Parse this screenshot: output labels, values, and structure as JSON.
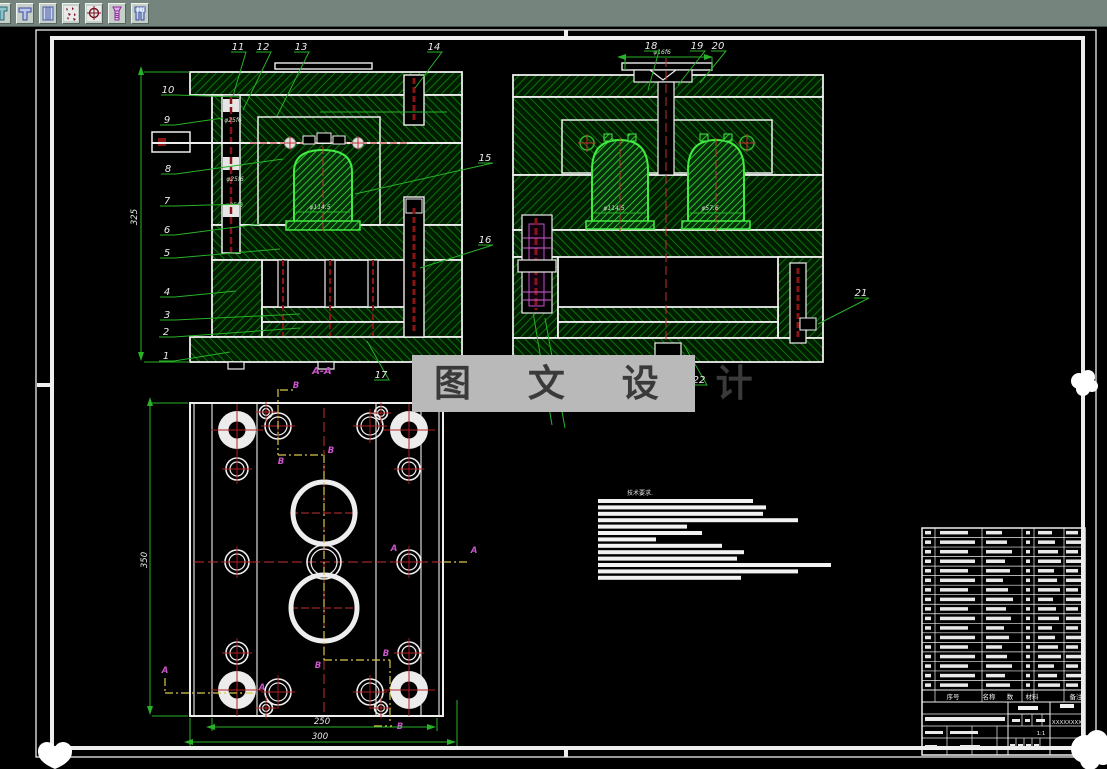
{
  "app": {
    "toolbar": {
      "icons": [
        "stepped-part-icon",
        "t-slot-part-icon",
        "bushing-icon",
        "spatter-pattern-icon",
        "crosshair-target-icon",
        "screw-icon",
        "striped-part-icon"
      ]
    }
  },
  "drawing": {
    "watermark": "图 文 设 计",
    "aa_label": "A-A",
    "callouts": [
      "1",
      "2",
      "3",
      "4",
      "5",
      "6",
      "7",
      "8",
      "9",
      "10",
      "11",
      "12",
      "13",
      "14",
      "15",
      "16",
      "17",
      "18",
      "19",
      "20",
      "21",
      "22"
    ],
    "letters": {
      "a": "A",
      "b": "B"
    },
    "dims": {
      "v1_height": "325",
      "pin_dia": "φ25f6",
      "v1_cavity_dia": "φ114.5",
      "v2_sprue_dia": "φ16f6",
      "v2_cavity_left": "φ114.5",
      "v2_cavity_right": "φ57.6",
      "plan_height": "350",
      "plan_inner_width": "250",
      "plan_outer_width": "300"
    },
    "tech_title": "技术要求.",
    "bom_header": [
      "序号",
      "名称",
      "数",
      "材料",
      "备注"
    ],
    "title_block": {
      "drawing_no": "XXXXXXXX",
      "scale": "1:1"
    }
  }
}
